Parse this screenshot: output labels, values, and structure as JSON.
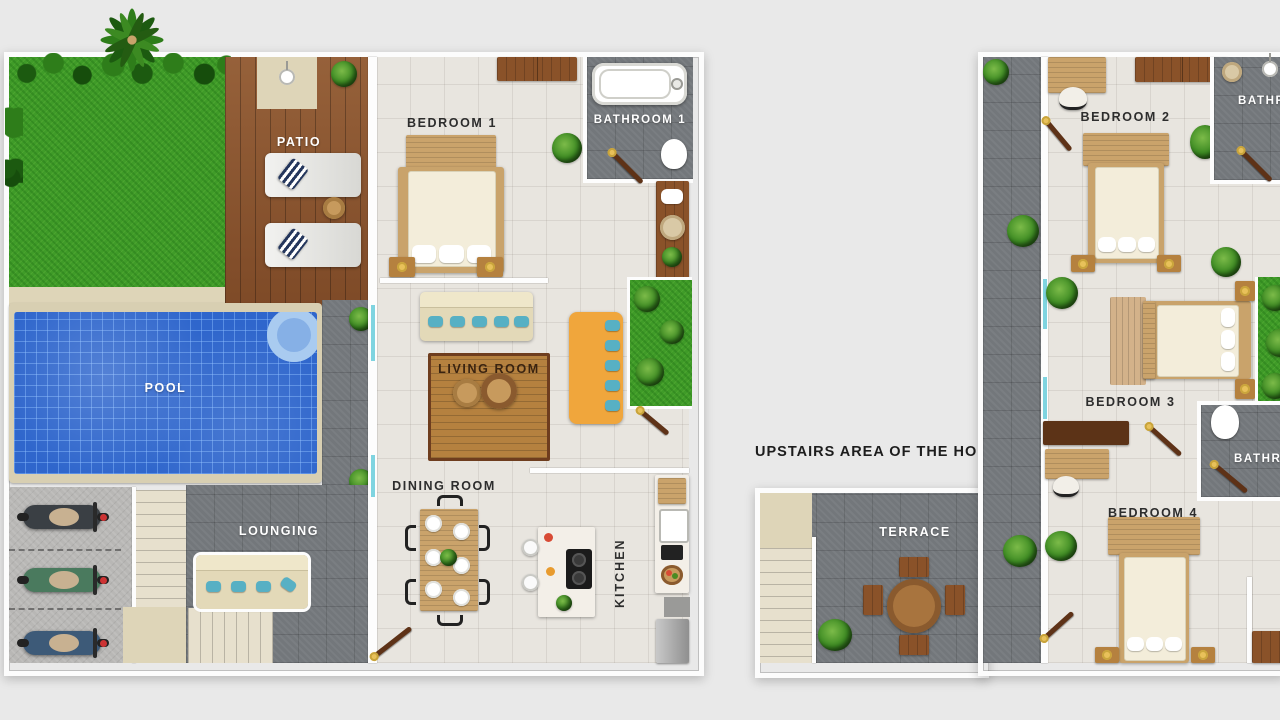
{
  "page": {
    "background": "#e9e9e9"
  },
  "divider_label": "UPSTAIRS AREA OF THE HOUSE",
  "ground_floor": {
    "labels": {
      "patio": "PATIO",
      "pool": "POOL",
      "lounging": "LOUNGING",
      "bedroom1": "BEDROOM 1",
      "bathroom1": "BATHROOM 1",
      "living_room": "LIVING ROOM",
      "dining_room": "DINING ROOM",
      "kitchen": "KITCHEN"
    }
  },
  "upper_floor": {
    "labels": {
      "bedroom2": "BEDROOM 2",
      "bathroom2": "BATHROOM",
      "bedroom3": "BEDROOM 3",
      "bathroom3": "BATHROOM",
      "bedroom4": "BEDROOM 4",
      "terrace": "TERRACE"
    }
  },
  "colors": {
    "background": "#e9e9e9",
    "dark_tile": "#73777b",
    "light_floor": "#e8e5df",
    "grass": "#3f9b28",
    "pool_water": "#2f66cc",
    "pool_coping": "#d8cfb2",
    "wood_deck": "#8a5531",
    "daybed_orange": "#f0a63c",
    "pillow_teal": "#57b0c4",
    "wall_white": "#fdfdfd"
  }
}
